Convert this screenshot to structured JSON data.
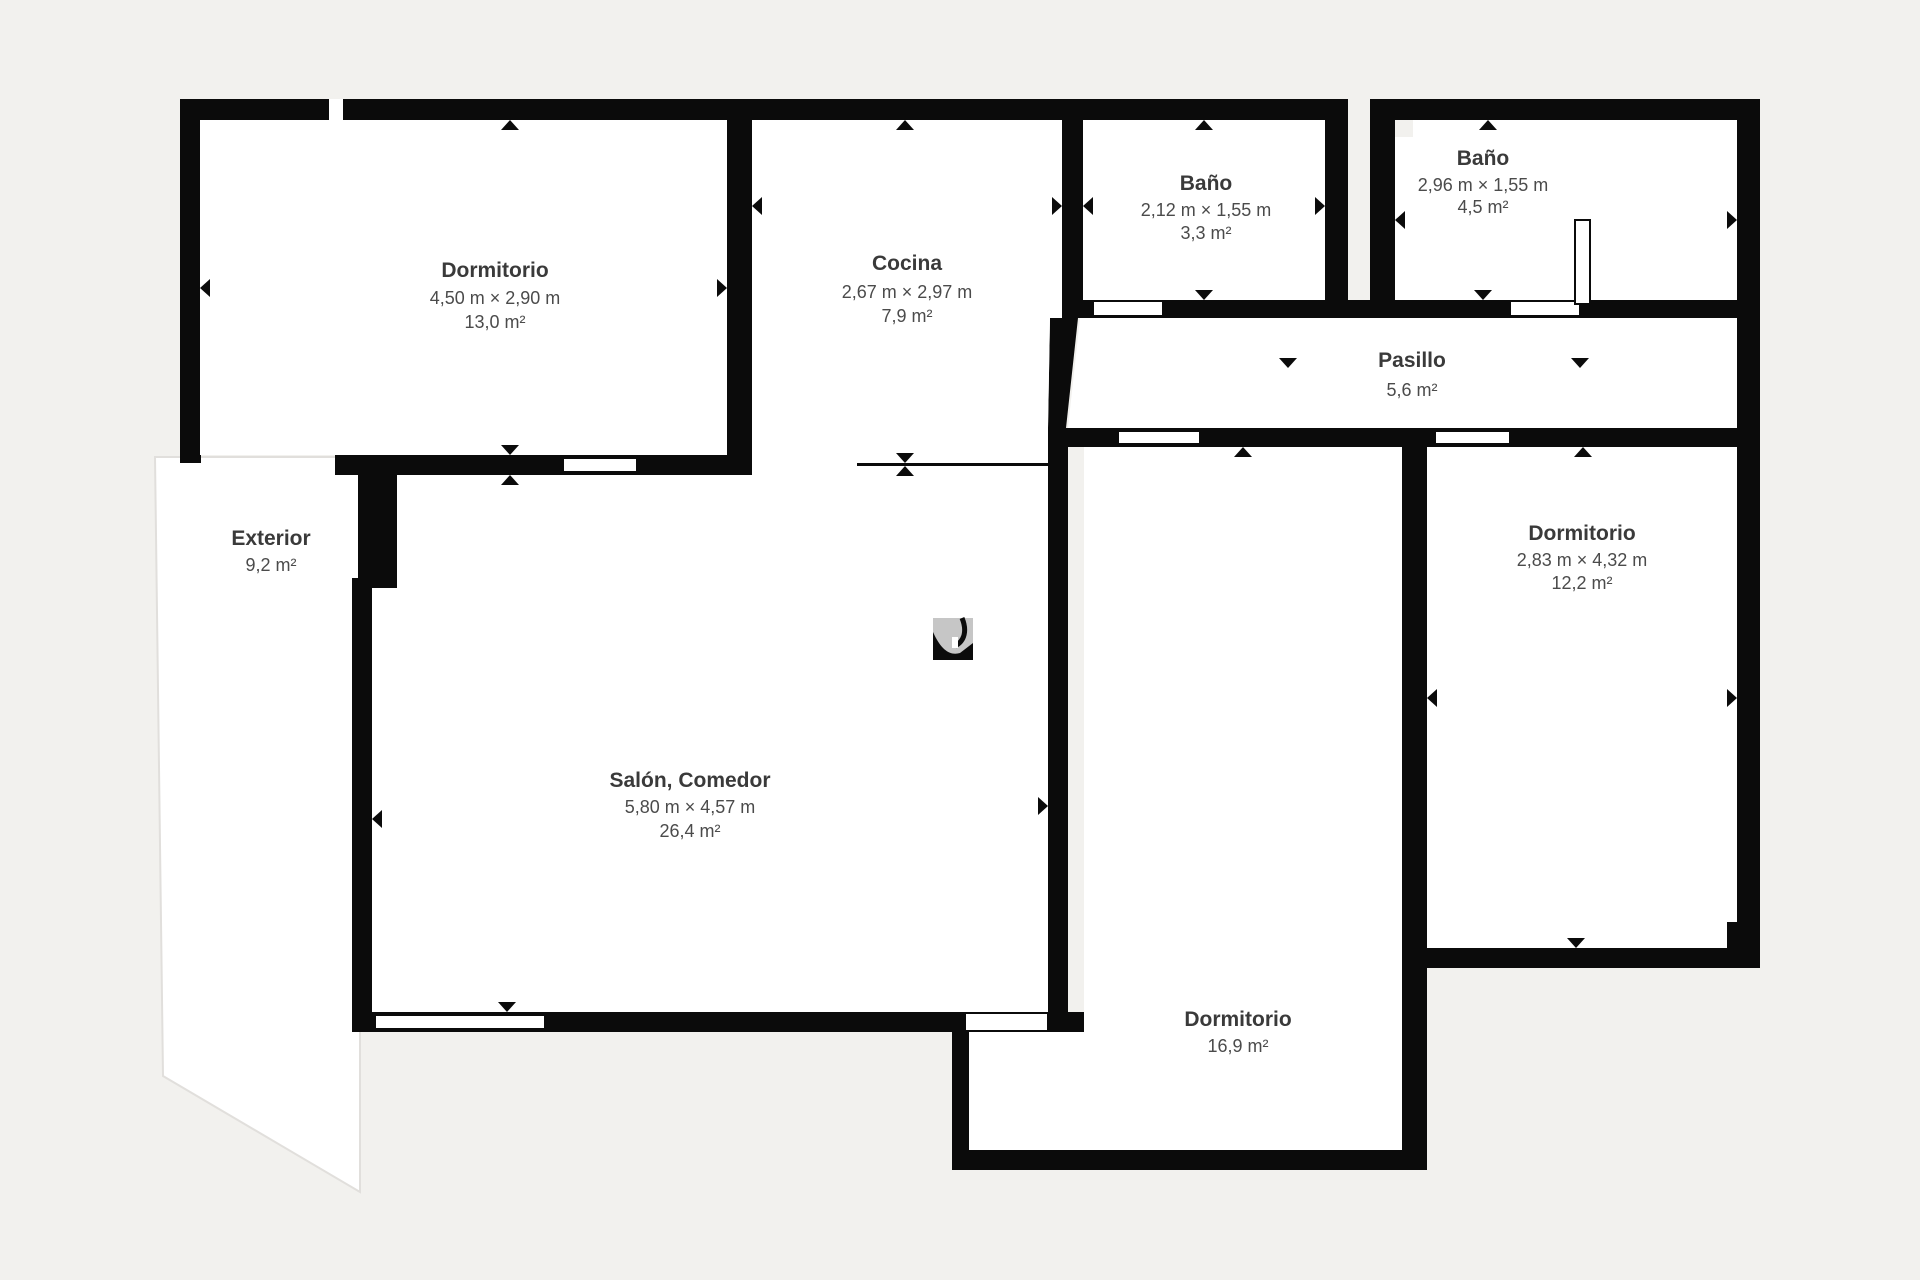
{
  "colors": {
    "background": "#f2f1ee",
    "wall": "#0b0b0b",
    "room_fill": "#ffffff",
    "title_text": "#3a3a3a",
    "dimension_text": "#4b4b4b"
  },
  "rooms": {
    "dormitorio1": {
      "name": "Dormitorio",
      "dims": "4,50 m × 2,90 m",
      "area": "13,0 m²"
    },
    "cocina": {
      "name": "Cocina",
      "dims": "2,67 m × 2,97 m",
      "area": "7,9 m²"
    },
    "bano1": {
      "name": "Baño",
      "dims": "2,12 m × 1,55 m",
      "area": "3,3 m²"
    },
    "bano2": {
      "name": "Baño",
      "dims": "2,96 m × 1,55 m",
      "area": "4,5 m²"
    },
    "pasillo": {
      "name": "Pasillo",
      "area": "5,6 m²"
    },
    "exterior": {
      "name": "Exterior",
      "area": "9,2 m²"
    },
    "salon": {
      "name": "Salón, Comedor",
      "dims": "5,80 m × 4,57 m",
      "area": "26,4 m²"
    },
    "dormitorio2": {
      "name": "Dormitorio",
      "dims": "2,83 m × 4,32 m",
      "area": "12,2 m²"
    },
    "dormitorio3": {
      "name": "Dormitorio",
      "area": "16,9 m²"
    }
  }
}
